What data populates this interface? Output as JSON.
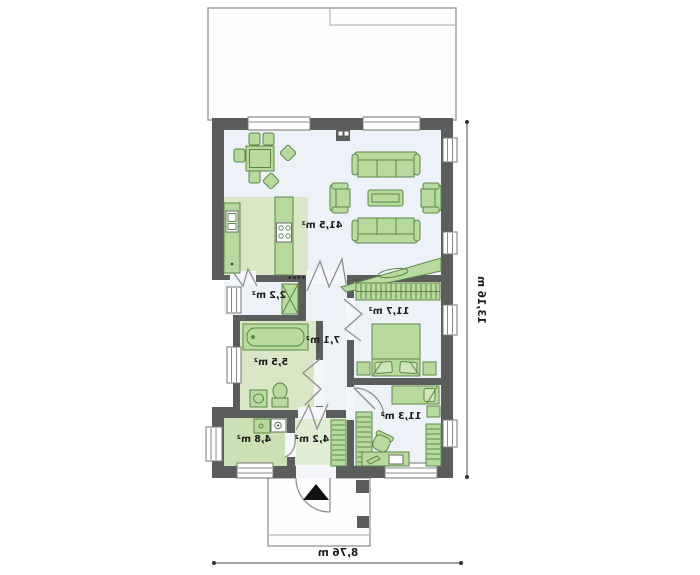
{
  "areas": {
    "living": "41,5 m²",
    "pantry": "2,2 m²",
    "bathroom": "5,5 m²",
    "hall": "7,1 m²",
    "bedroom": "11,7 m²",
    "bedroom2": "11,3 m²",
    "utility": "4,8 m²",
    "entry": "4,2 m²"
  },
  "dimensions": {
    "depth": "13,16 m",
    "width": "8,76 m"
  },
  "colors": {
    "wall": "#5b5c5c",
    "floor_light": "#edf2f8",
    "floor_green": "#d9e7c7",
    "floor_green_strong": "#cbe0b4",
    "floor_green_soft": "#e2eed3",
    "furniture": "#b7da9e",
    "furniture_light": "#cfe5ba",
    "furniture_border": "#5d8549"
  }
}
